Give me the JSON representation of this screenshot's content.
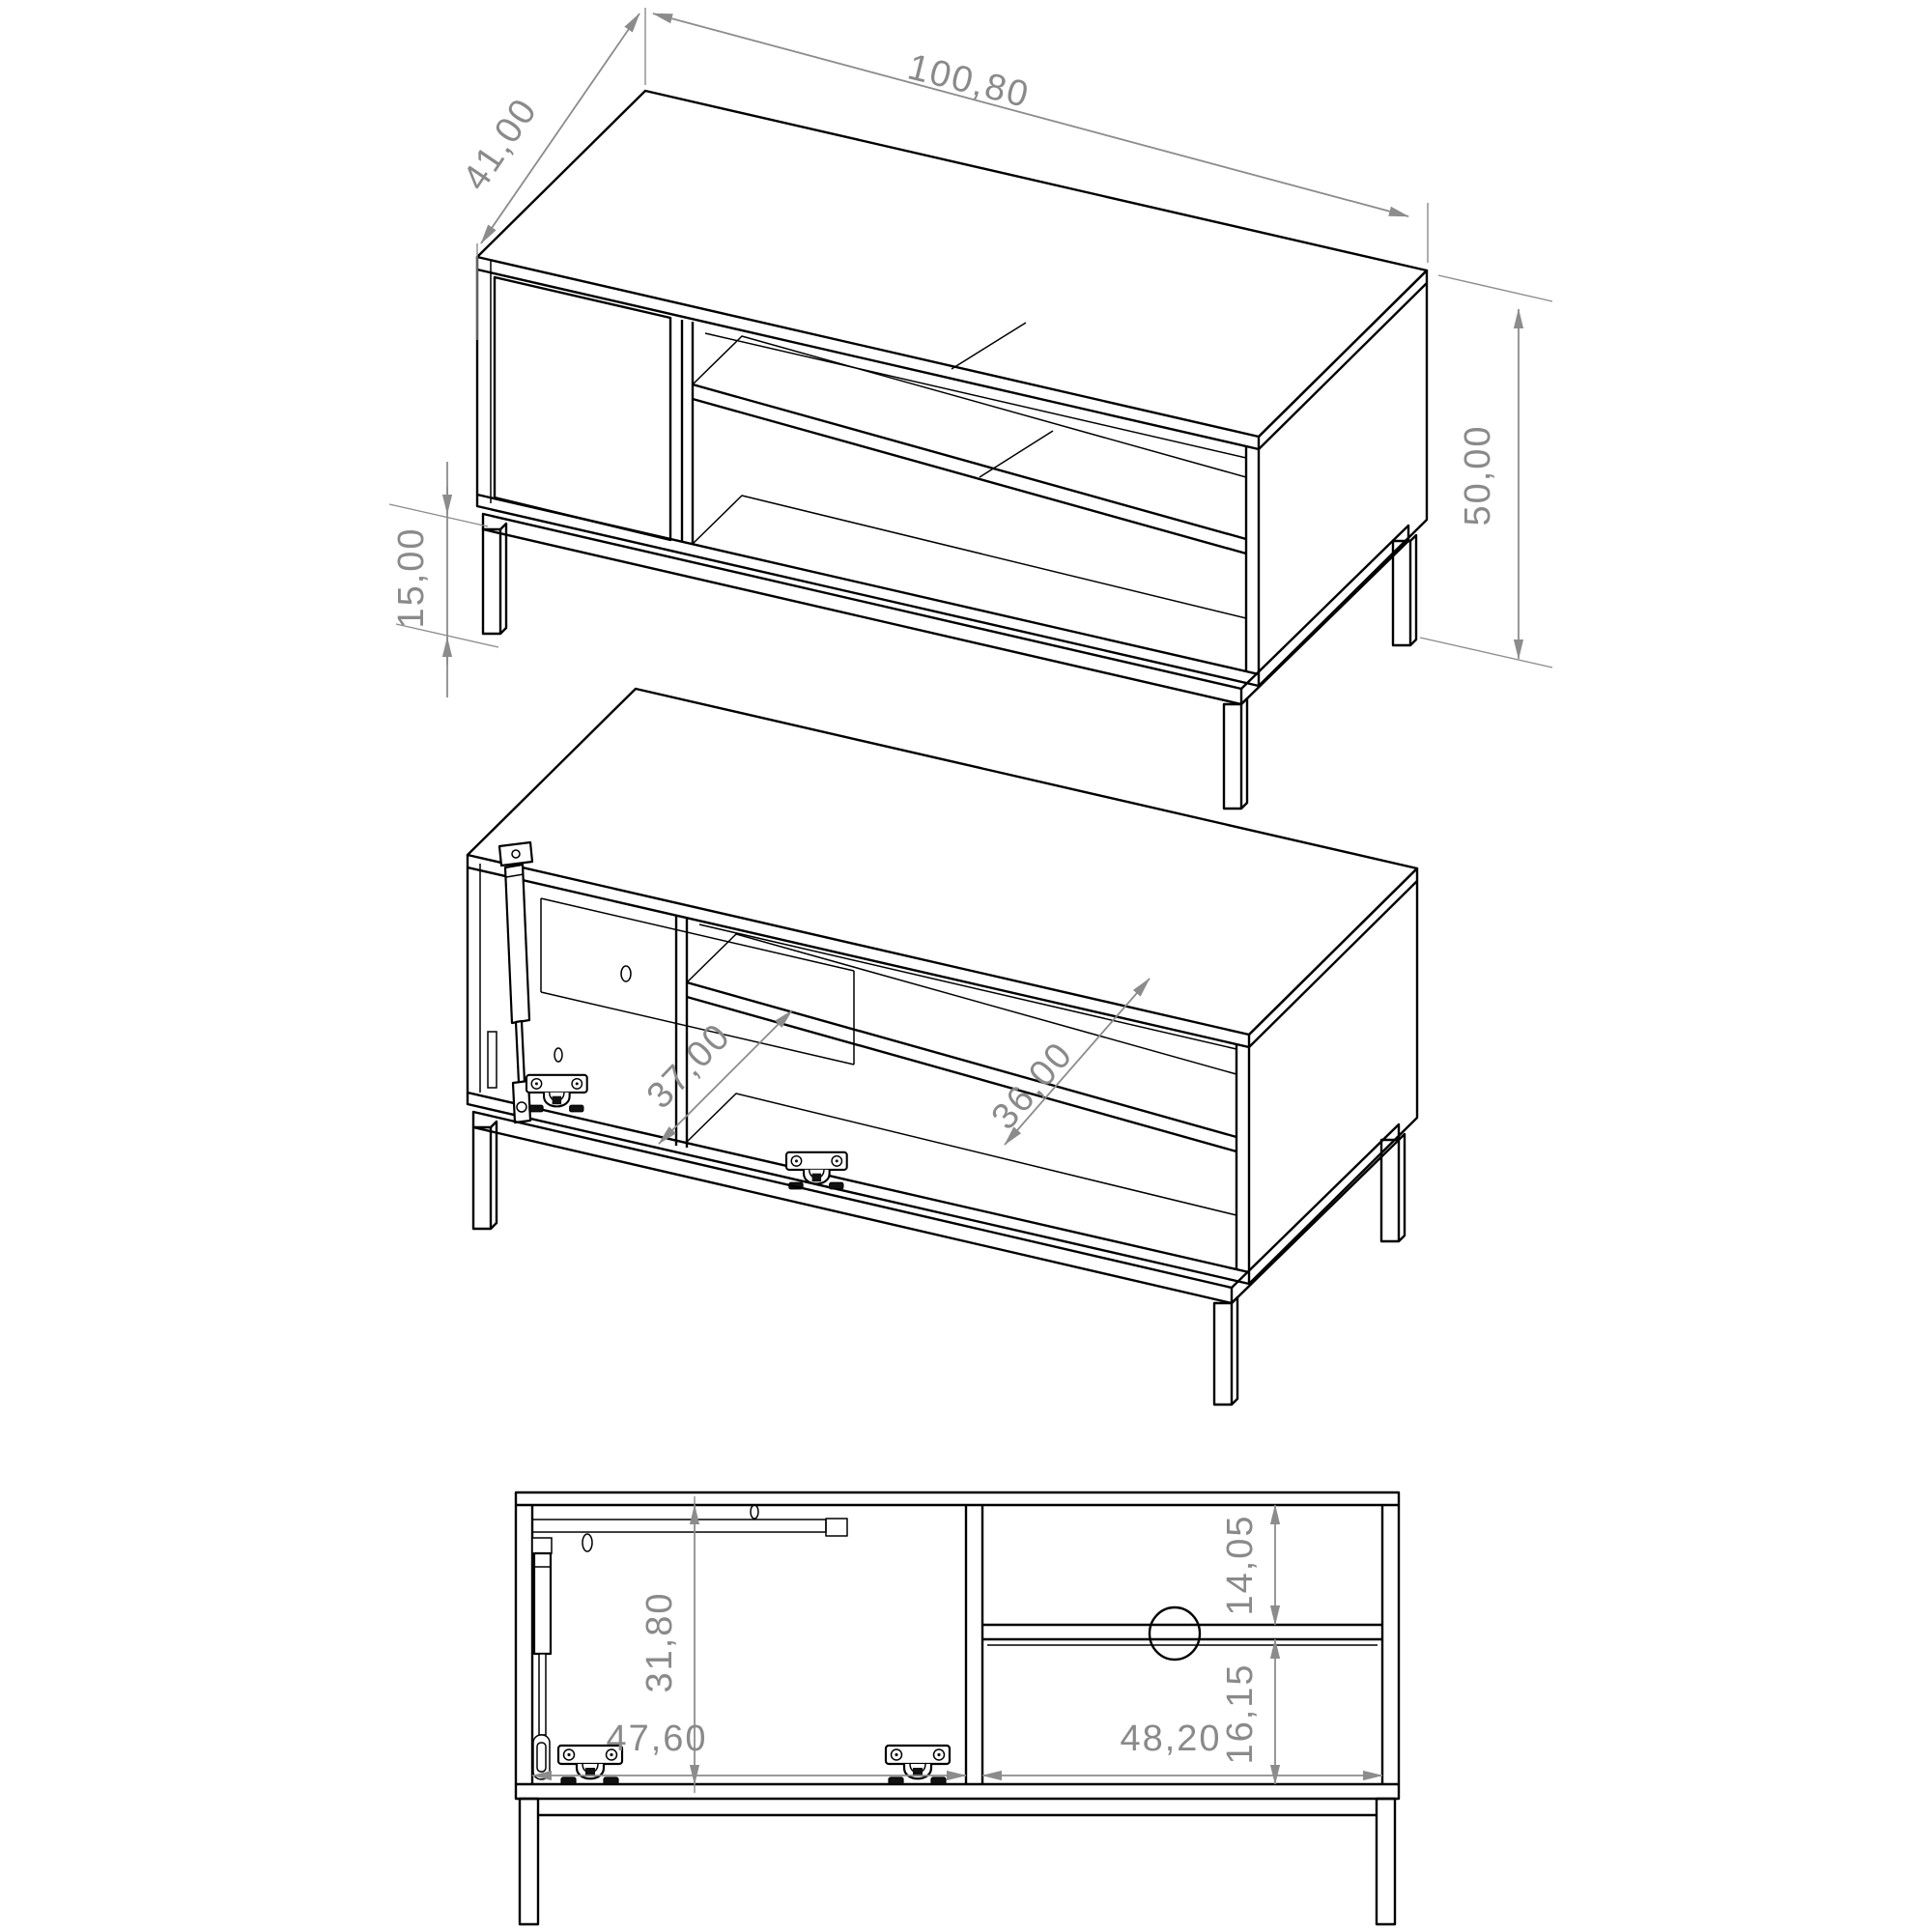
{
  "drawing": {
    "colors": {
      "line": "#000000",
      "dimension_line": "#8c8c8c",
      "dimension_text": "#8a8a8a",
      "background": "#ffffff"
    },
    "views": {
      "iso_closed": {
        "width": "100,80",
        "depth": "41,00",
        "height": "50,00",
        "leg_height": "15,00"
      },
      "iso_open": {
        "left_compartment_depth": "37,00",
        "shelf_depth": "36,00"
      },
      "front_elevation": {
        "interior_height": "31,80",
        "left_compartment_width": "47,60",
        "right_compartment_width": "48,20",
        "shelf_space_upper": "14,05",
        "shelf_space_lower": "16,15"
      }
    }
  }
}
